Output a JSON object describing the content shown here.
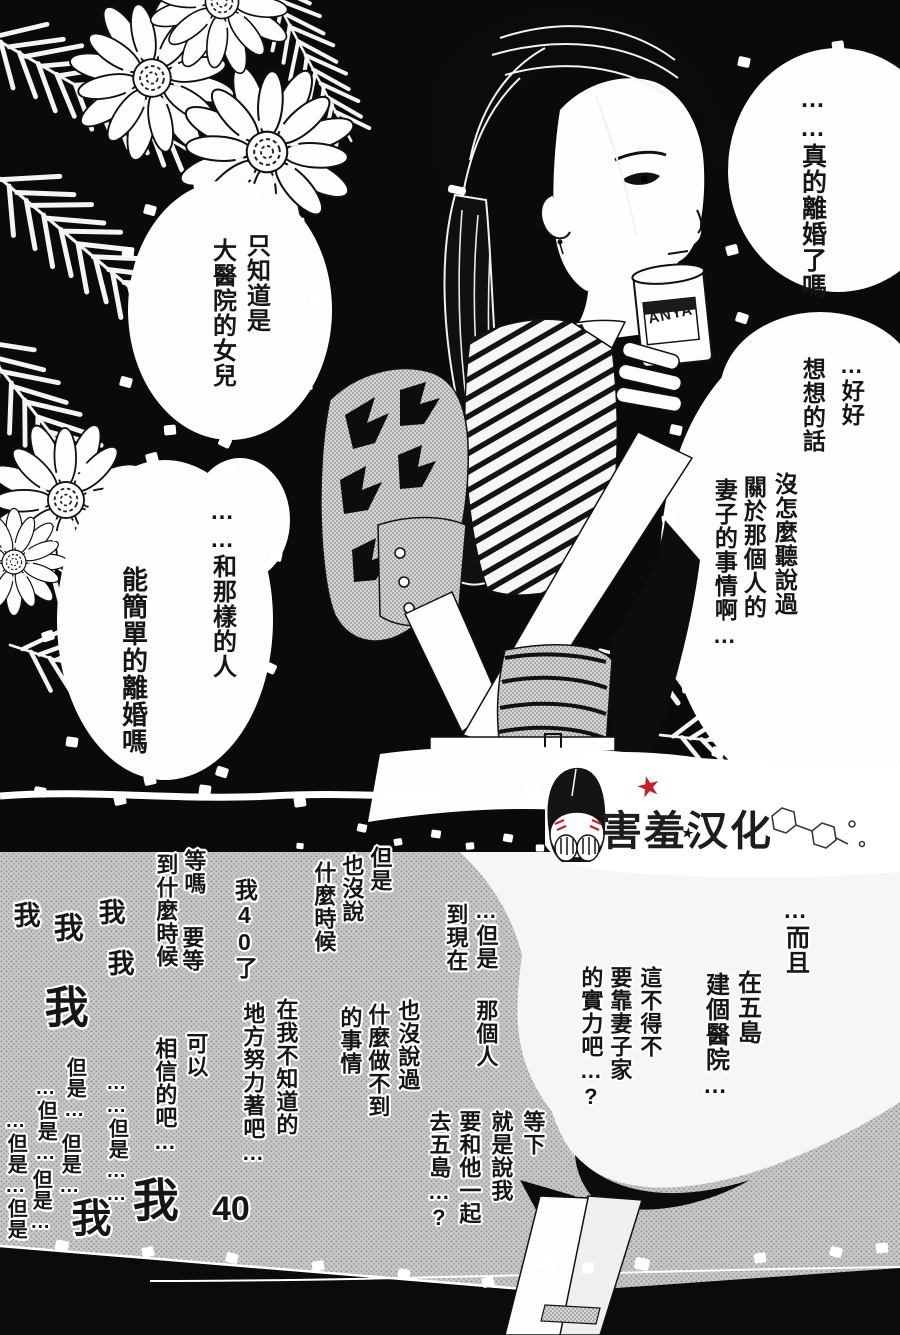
{
  "panel_top": {
    "bubble_top_right": {
      "line1": "……真的離婚了嗎"
    },
    "thought_right": {
      "line1": "…好好",
      "line2": "想想的話"
    },
    "bubble_right": {
      "line1": "沒怎麼聽說過",
      "line2": "關於那個人的",
      "line3": "妻子的事情啊…"
    },
    "bubble_left_upper": {
      "line1": "只知道是",
      "line2": "大醫院的女兒"
    },
    "bubble_left_lower": {
      "line1": "……和那樣的人",
      "line2": "能簡單的離婚嗎"
    },
    "cup_label": "ANYA"
  },
  "watermark": {
    "text": "害羞汉化",
    "star_red": "★",
    "star_black": "★",
    "accent_red": "#c41f2e"
  },
  "panel_bottom": {
    "floats": [
      {
        "text": "但是"
      },
      {
        "text": "也沒說"
      },
      {
        "text": "什麼時候"
      },
      {
        "text": "我40了"
      },
      {
        "text": "等嗎"
      },
      {
        "text": "要等"
      },
      {
        "text": "到什麼時候"
      },
      {
        "text": "我"
      },
      {
        "text": "我"
      },
      {
        "text": "我"
      },
      {
        "text": "我"
      },
      {
        "text": "我"
      },
      {
        "text": "…但是"
      },
      {
        "text": "到現在"
      },
      {
        "text": "那個人"
      },
      {
        "text": "也沒說過"
      },
      {
        "text": "什麼做不到"
      },
      {
        "text": "的事情"
      },
      {
        "text": "在我不知道的"
      },
      {
        "text": "地方努力著吧…"
      },
      {
        "text": "可以"
      },
      {
        "text": "相信的吧…"
      },
      {
        "text": "……但是……"
      },
      {
        "text": "但是…"
      },
      {
        "text": "…但是…"
      },
      {
        "text": "但是…"
      },
      {
        "text": "但是…"
      },
      {
        "text": "…但是…但是"
      },
      {
        "text": "我"
      },
      {
        "text": "我"
      },
      {
        "text": "40"
      },
      {
        "text": "…而且"
      },
      {
        "text": "在五島"
      },
      {
        "text": "建個醫院…"
      },
      {
        "text": "這不得不"
      },
      {
        "text": "要靠妻子家"
      },
      {
        "text": "的實力吧…?"
      },
      {
        "text": "等下"
      },
      {
        "text": "就是說我"
      },
      {
        "text": "要和他一起"
      },
      {
        "text": "去五島…?"
      }
    ]
  }
}
